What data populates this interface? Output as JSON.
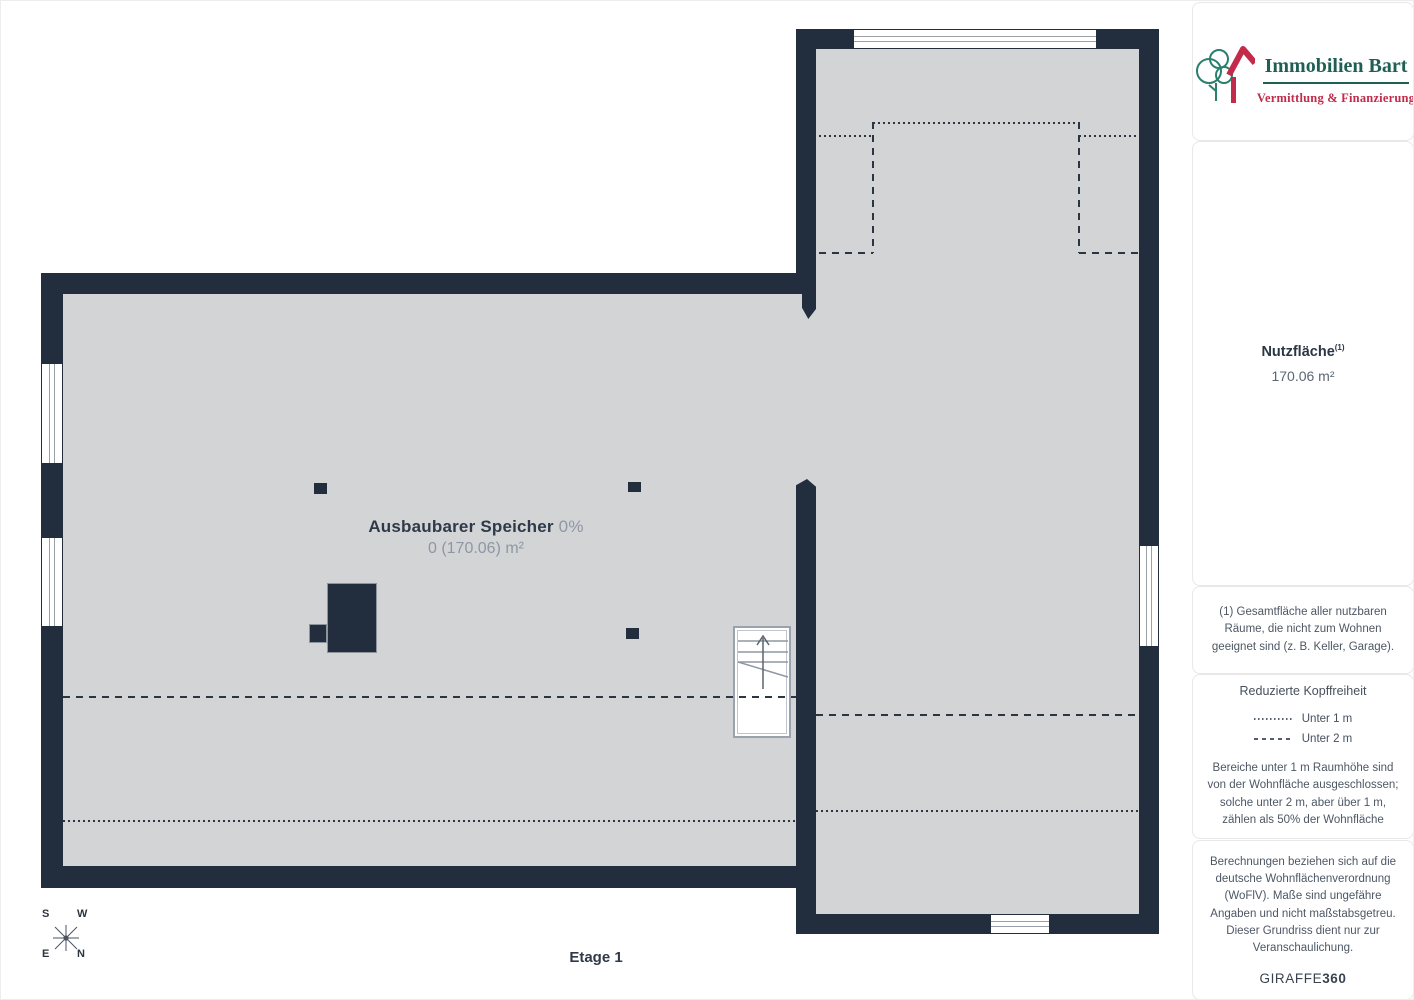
{
  "plan": {
    "room_name": "Ausbaubarer Speicher",
    "room_pct": "0%",
    "room_area": "0 (170.06) m²",
    "floor_label": "Etage 1",
    "compass": {
      "s": "S",
      "w": "W",
      "e": "E",
      "n": "N"
    }
  },
  "sidebar": {
    "logo": {
      "title": "Immobilien Bart",
      "tagline": "Vermittlung & Finanzierung"
    },
    "area": {
      "label": "Nutzfläche",
      "footnote_ref": "(1)",
      "value": "170.06 m²"
    },
    "footnote": "(1) Gesamtfläche aller nutzbaren Räume, die nicht zum Wohnen geeignet sind (z. B. Keller, Garage).",
    "headroom": {
      "title": "Reduzierte Kopffreiheit",
      "legend": [
        {
          "style": "dotted",
          "label": "Unter 1 m"
        },
        {
          "style": "dashed",
          "label": "Unter 2 m"
        }
      ],
      "note": "Bereiche unter 1 m Raumhöhe sind von der Wohnfläche ausgeschlossen; solche unter 2 m, aber über 1 m, zählen als 50% der Wohnfläche"
    },
    "disclaimer": "Berechnungen beziehen sich auf die deutsche Wohnflächenverordnung (WoFlV). Maße sind ungefähre Angaben und nicht maßstabsgetreu. Dieser Grundriss dient nur zur Veranschaulichung.",
    "brand": {
      "name": "GIRAFFE",
      "suffix": "360"
    }
  },
  "colors": {
    "wall": "#222e3e",
    "floor": "#d3d4d5",
    "dash_line": "#2b3644",
    "logo_green": "#1e6056",
    "logo_red": "#c22b49"
  }
}
